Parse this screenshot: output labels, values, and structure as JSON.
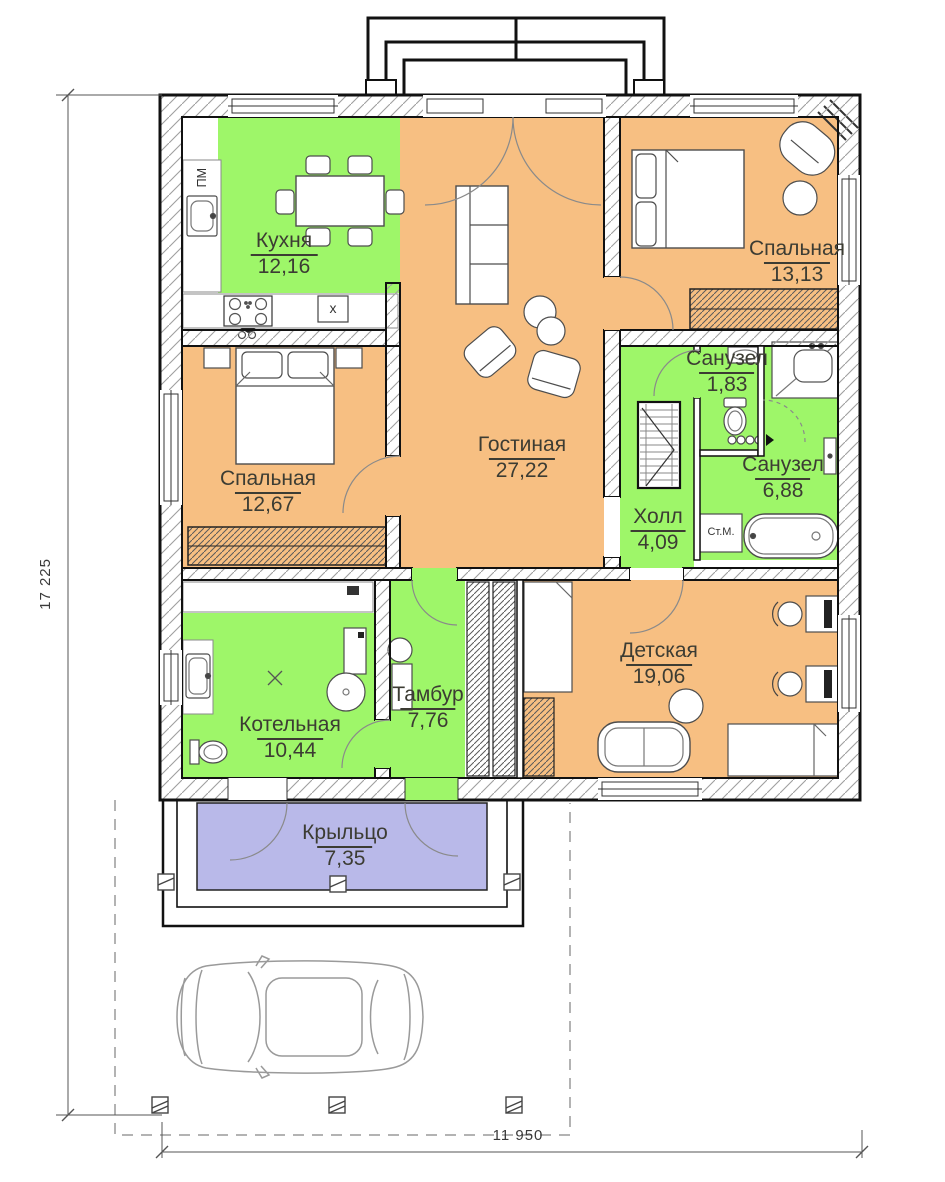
{
  "plan": {
    "rooms": [
      {
        "id": "kitchen",
        "name": "Кухня",
        "area": "12,16"
      },
      {
        "id": "living",
        "name": "Гостиная",
        "area": "27,22"
      },
      {
        "id": "bedroom-right",
        "name": "Спальная",
        "area": "13,13"
      },
      {
        "id": "bedroom-left",
        "name": "Спальная",
        "area": "12,67"
      },
      {
        "id": "bathroom-small",
        "name": "Санузел",
        "area": "1,83"
      },
      {
        "id": "bathroom-big",
        "name": "Санузел",
        "area": "6,88"
      },
      {
        "id": "hall",
        "name": "Холл",
        "area": "4,09"
      },
      {
        "id": "boiler-room",
        "name": "Котельная",
        "area": "10,44"
      },
      {
        "id": "vestibule",
        "name": "Тамбур",
        "area": "7,76"
      },
      {
        "id": "kids-room",
        "name": "Детская",
        "area": "19,06"
      },
      {
        "id": "porch",
        "name": "Крыльцо",
        "area": "7,35"
      }
    ],
    "dimensions": {
      "total_height": "17 225",
      "total_width": "11 950"
    },
    "markers": {
      "dishwasher": "ПМ",
      "washing_machine": "Ст.М.",
      "kitchen_sink": "x"
    },
    "colors": {
      "wet_rooms": "#9ef669",
      "dry_rooms": "#f7bf82",
      "porch": "#b9b9e9"
    }
  }
}
